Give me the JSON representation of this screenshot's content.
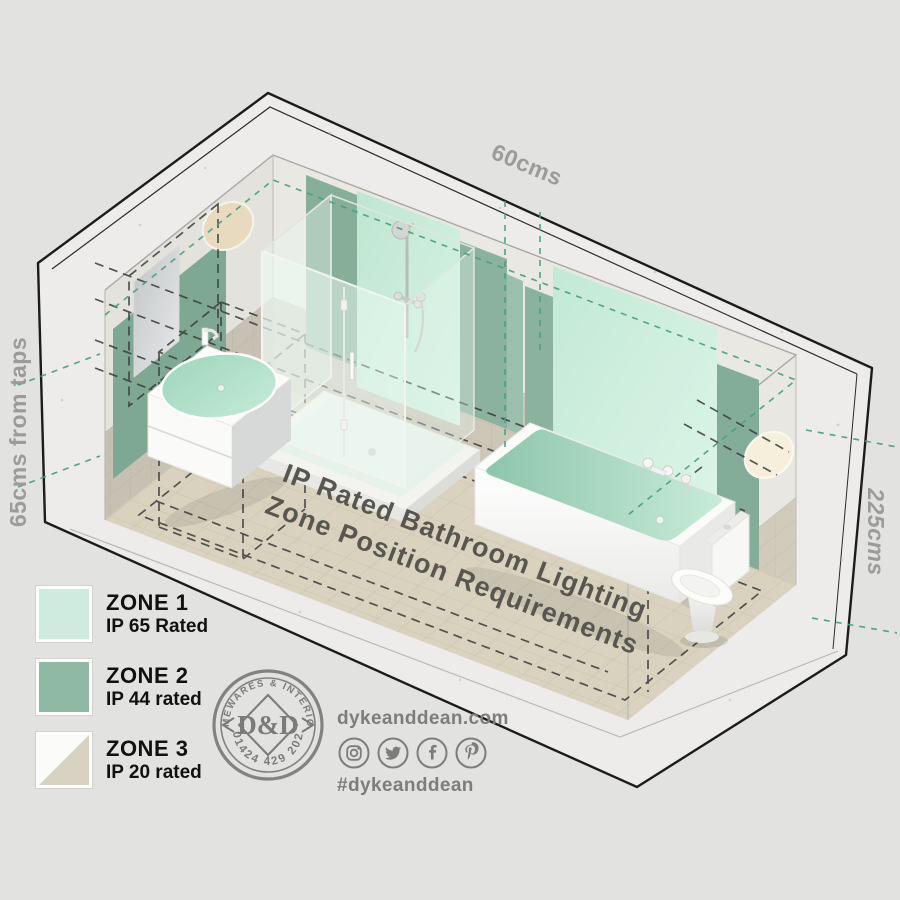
{
  "dimensions": {
    "top": "60cms",
    "left": "65cms from taps",
    "right": "225cms"
  },
  "floor_title": {
    "line1": "IP Rated Bathroom Lighting",
    "line2": "Zone Position Requirements"
  },
  "legend": {
    "items": [
      {
        "name": "ZONE 1",
        "rating": "IP 65 Rated",
        "color": "#cfeadf"
      },
      {
        "name": "ZONE 2",
        "rating": "IP 44 rated",
        "color": "#8fb9a5"
      },
      {
        "name": "ZONE 3",
        "rating": "IP 20 rated",
        "color_top": "#fbfbf9",
        "color_bottom": "#d8d2c2",
        "swatch_css": "linear-gradient(135deg, #fbfbf9 49.5%, #d8d2c2 50.5%)"
      }
    ]
  },
  "logo": {
    "arc_top": "HOMEWARES & INTERIORS",
    "monogram": "D&D",
    "arc_bottom": "01424 429 202"
  },
  "social": {
    "website": "dykeanddean.com",
    "hashtag": "#dykeanddean",
    "icons": [
      "instagram-icon",
      "twitter-icon",
      "facebook-icon",
      "pinterest-icon"
    ]
  },
  "colors": {
    "background": "#e2e2e1",
    "zone1_mint": "#c9ecdb",
    "zone2_green": "#8ab29e",
    "zone3_tile": "#d4cec0",
    "teal_dash": "#4c9f81",
    "black_dash": "#3b3b3b",
    "floor": "#d8d2bf",
    "label_gray": "#9c9b99"
  }
}
